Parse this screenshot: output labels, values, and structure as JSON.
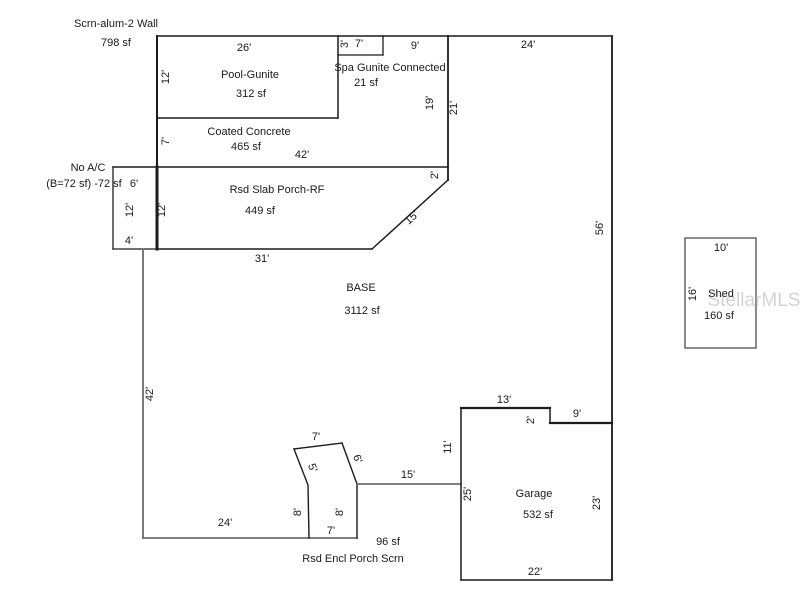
{
  "floor_plan": {
    "canvas": {
      "width": 800,
      "height": 600,
      "background": "#ffffff"
    },
    "colors": {
      "line": "#1c1c1c",
      "muted_line": "#6e6e6e",
      "base_edge": "#7a7a7a",
      "shed_line": "#4a4a4a",
      "text": "#1a1a1a",
      "watermark": "#c9c9c9"
    },
    "areas": [
      {
        "name": "Scrn-alum-2 Wall",
        "size": "798 sf"
      },
      {
        "name": "Pool-Gunite",
        "size": "312 sf"
      },
      {
        "name": "Spa Gunite Connected",
        "size": "21 sf"
      },
      {
        "name": "Coated Concrete",
        "size": "465 sf"
      },
      {
        "name": "No A/C",
        "size": "(B=72 sf) -72 sf"
      },
      {
        "name": "Rsd Slab Porch-RF",
        "size": "449 sf"
      },
      {
        "name": "BASE",
        "size": "3112 sf"
      },
      {
        "name": "Rsd Encl Porch Scrn",
        "size": "96 sf"
      },
      {
        "name": "Garage",
        "size": "532 sf"
      },
      {
        "name": "Shed",
        "size": "160 sf"
      }
    ],
    "watermark": {
      "text": "StellarMLS",
      "x": 754,
      "y": 301,
      "size": 19
    },
    "lines": [
      {
        "name": "top-wall",
        "points": [
          [
            157,
            36
          ],
          [
            612,
            36
          ]
        ],
        "w": 1.5
      },
      {
        "name": "enclosure-left-wall",
        "points": [
          [
            157,
            36
          ],
          [
            157,
            167
          ]
        ],
        "w": 2
      },
      {
        "name": "slab-porch-left-wall",
        "points": [
          [
            157,
            167
          ],
          [
            157,
            249
          ]
        ],
        "w": 3
      },
      {
        "name": "pool-bottom-wall",
        "points": [
          [
            157,
            118
          ],
          [
            338,
            118
          ]
        ],
        "w": 1.5
      },
      {
        "name": "pool-right-wall",
        "points": [
          [
            338,
            36
          ],
          [
            338,
            118
          ]
        ],
        "w": 1.5
      },
      {
        "name": "spa-bottom-wall",
        "points": [
          [
            338,
            55
          ],
          [
            383,
            55
          ]
        ],
        "w": 1.3
      },
      {
        "name": "spa-right-wall",
        "points": [
          [
            383,
            36
          ],
          [
            383,
            55
          ]
        ],
        "w": 1.3
      },
      {
        "name": "enclosure-right-wall",
        "points": [
          [
            448,
            36
          ],
          [
            448,
            180
          ]
        ],
        "w": 1.8
      },
      {
        "name": "slab-porch-top-wall",
        "points": [
          [
            113,
            167
          ],
          [
            448,
            167
          ]
        ],
        "w": 1.5
      },
      {
        "name": "noac-left-wall",
        "points": [
          [
            113,
            167
          ],
          [
            113,
            249
          ]
        ],
        "w": 1.3
      },
      {
        "name": "noac-bottom-wall",
        "points": [
          [
            113,
            249
          ],
          [
            157,
            249
          ]
        ],
        "w": 1.3
      },
      {
        "name": "slab-porch-bottom-wall",
        "points": [
          [
            157,
            249
          ],
          [
            372,
            249
          ]
        ],
        "w": 1.5
      },
      {
        "name": "slab-porch-diagonal-wall",
        "points": [
          [
            372,
            249
          ],
          [
            448,
            180
          ]
        ],
        "w": 1.5
      },
      {
        "name": "base-left-wall",
        "points": [
          [
            143,
            249
          ],
          [
            143,
            538
          ]
        ],
        "w": 2,
        "c": "#7a7a7a"
      },
      {
        "name": "base-bottom-wall",
        "points": [
          [
            143,
            538
          ],
          [
            357,
            538
          ]
        ],
        "w": 1.8,
        "c": "#6e6e6e"
      },
      {
        "name": "encl-porch-left-wall",
        "points": [
          [
            309,
            538
          ],
          [
            308,
            485
          ],
          [
            294,
            449
          ]
        ],
        "w": 1.4
      },
      {
        "name": "encl-porch-top-wall",
        "points": [
          [
            294,
            449
          ],
          [
            342,
            443
          ]
        ],
        "w": 1.4
      },
      {
        "name": "encl-porch-upper-right-wall",
        "points": [
          [
            342,
            443
          ],
          [
            357,
            484
          ]
        ],
        "w": 1.4
      },
      {
        "name": "encl-porch-right-wall",
        "points": [
          [
            357,
            484
          ],
          [
            357,
            538
          ]
        ],
        "w": 1.4
      },
      {
        "name": "base-lower-wall",
        "points": [
          [
            357,
            484
          ],
          [
            461,
            484
          ]
        ],
        "w": 1.8,
        "c": "#6e6e6e"
      },
      {
        "name": "garage-left-wall",
        "points": [
          [
            461,
            408
          ],
          [
            461,
            580
          ]
        ],
        "w": 1.5
      },
      {
        "name": "garage-top-wall",
        "points": [
          [
            461,
            408
          ],
          [
            550,
            408
          ]
        ],
        "w": 2.2
      },
      {
        "name": "garage-notch-wall",
        "points": [
          [
            550,
            408
          ],
          [
            550,
            423
          ]
        ],
        "w": 1.5
      },
      {
        "name": "garage-upper-right-wall",
        "points": [
          [
            550,
            423
          ],
          [
            612,
            423
          ]
        ],
        "w": 2.2
      },
      {
        "name": "right-wall",
        "points": [
          [
            612,
            36
          ],
          [
            612,
            580
          ]
        ],
        "w": 1.8
      },
      {
        "name": "garage-bottom-wall",
        "points": [
          [
            461,
            580
          ],
          [
            612,
            580
          ]
        ],
        "w": 1.5
      },
      {
        "name": "shed-outline",
        "points": [
          [
            685,
            238
          ],
          [
            756,
            238
          ],
          [
            756,
            348
          ],
          [
            685,
            348
          ],
          [
            685,
            238
          ]
        ],
        "w": 1.3,
        "c": "#4a4a4a"
      }
    ],
    "labels": [
      {
        "name": "scrn-wall-title",
        "text": "Scrn-alum-2 Wall",
        "x": 116,
        "y": 24
      },
      {
        "name": "scrn-wall-size",
        "text": "798 sf",
        "x": 116,
        "y": 43
      },
      {
        "name": "dim",
        "text": "26'",
        "x": 244,
        "y": 48
      },
      {
        "name": "dim",
        "text": "12'",
        "x": 166,
        "y": 77,
        "rot": -90
      },
      {
        "name": "pool-title",
        "text": "Pool-Gunite",
        "x": 250,
        "y": 75
      },
      {
        "name": "pool-size",
        "text": "312 sf",
        "x": 251,
        "y": 94
      },
      {
        "name": "dim",
        "text": "3'",
        "x": 345,
        "y": 44,
        "rot": -90
      },
      {
        "name": "dim",
        "text": "7'",
        "x": 359,
        "y": 44
      },
      {
        "name": "dim",
        "text": "9'",
        "x": 415,
        "y": 46
      },
      {
        "name": "dim",
        "text": "24'",
        "x": 528,
        "y": 45
      },
      {
        "name": "spa-title",
        "text": "Spa Gunite Connected",
        "x": 390,
        "y": 68
      },
      {
        "name": "spa-size",
        "text": "21 sf",
        "x": 366,
        "y": 83
      },
      {
        "name": "coated-concrete-title",
        "text": "Coated Concrete",
        "x": 249,
        "y": 132
      },
      {
        "name": "coated-concrete-size",
        "text": "465 sf",
        "x": 246,
        "y": 147
      },
      {
        "name": "dim",
        "text": "7'",
        "x": 166,
        "y": 141,
        "rot": -90
      },
      {
        "name": "dim",
        "text": "42'",
        "x": 302,
        "y": 155
      },
      {
        "name": "dim",
        "text": "19'",
        "x": 430,
        "y": 103,
        "rot": -90
      },
      {
        "name": "dim",
        "text": "21'",
        "x": 454,
        "y": 108,
        "rot": -90
      },
      {
        "name": "noac-title",
        "text": "No A/C",
        "x": 88,
        "y": 168
      },
      {
        "name": "noac-note",
        "text": "(B=72 sf) -72 sf",
        "x": 84,
        "y": 184
      },
      {
        "name": "dim",
        "text": "6'",
        "x": 134,
        "y": 184
      },
      {
        "name": "dim",
        "text": "12'",
        "x": 130,
        "y": 210,
        "rot": -90
      },
      {
        "name": "dim",
        "text": "12'",
        "x": 162,
        "y": 210,
        "rot": -90
      },
      {
        "name": "slab-porch-title",
        "text": "Rsd Slab Porch-RF",
        "x": 277,
        "y": 190
      },
      {
        "name": "slab-porch-size",
        "text": "449 sf",
        "x": 260,
        "y": 211
      },
      {
        "name": "dim",
        "text": "2'",
        "x": 435,
        "y": 175,
        "rot": -90
      },
      {
        "name": "dim",
        "text": "15'",
        "x": 412,
        "y": 218,
        "rot": -42
      },
      {
        "name": "dim",
        "text": "4'",
        "x": 129,
        "y": 241
      },
      {
        "name": "dim",
        "text": "31'",
        "x": 262,
        "y": 259
      },
      {
        "name": "base-title",
        "text": "BASE",
        "x": 361,
        "y": 288
      },
      {
        "name": "base-size",
        "text": "3112 sf",
        "x": 362,
        "y": 311
      },
      {
        "name": "dim",
        "text": "56'",
        "x": 600,
        "y": 228,
        "rot": -90
      },
      {
        "name": "dim",
        "text": "42'",
        "x": 150,
        "y": 394,
        "rot": -90
      },
      {
        "name": "dim",
        "text": "7'",
        "x": 316,
        "y": 437
      },
      {
        "name": "dim",
        "text": "5'",
        "x": 312,
        "y": 468,
        "rot": 70
      },
      {
        "name": "dim",
        "text": "6'",
        "x": 357,
        "y": 459,
        "rot": 70
      },
      {
        "name": "dim",
        "text": "8'",
        "x": 298,
        "y": 512,
        "rot": -90
      },
      {
        "name": "dim",
        "text": "8'",
        "x": 340,
        "y": 512,
        "rot": -90
      },
      {
        "name": "dim",
        "text": "7'",
        "x": 331,
        "y": 531
      },
      {
        "name": "dim",
        "text": "24'",
        "x": 225,
        "y": 523
      },
      {
        "name": "dim",
        "text": "15'",
        "x": 408,
        "y": 475
      },
      {
        "name": "encl-porch-size",
        "text": "96 sf",
        "x": 388,
        "y": 542
      },
      {
        "name": "encl-porch-title",
        "text": "Rsd Encl Porch Scrn",
        "x": 353,
        "y": 559
      },
      {
        "name": "dim",
        "text": "11'",
        "x": 448,
        "y": 447,
        "rot": -90
      },
      {
        "name": "dim",
        "text": "13'",
        "x": 504,
        "y": 400
      },
      {
        "name": "dim",
        "text": "2'",
        "x": 531,
        "y": 420,
        "rot": -90
      },
      {
        "name": "dim",
        "text": "9'",
        "x": 577,
        "y": 414
      },
      {
        "name": "dim",
        "text": "25'",
        "x": 468,
        "y": 494,
        "rot": -90
      },
      {
        "name": "garage-title",
        "text": "Garage",
        "x": 534,
        "y": 494
      },
      {
        "name": "garage-size",
        "text": "532 sf",
        "x": 538,
        "y": 515
      },
      {
        "name": "dim",
        "text": "23'",
        "x": 597,
        "y": 503,
        "rot": -90
      },
      {
        "name": "dim",
        "text": "22'",
        "x": 535,
        "y": 572
      },
      {
        "name": "dim",
        "text": "10'",
        "x": 721,
        "y": 248
      },
      {
        "name": "dim",
        "text": "16'",
        "x": 693,
        "y": 294,
        "rot": -90
      },
      {
        "name": "shed-title",
        "text": "Shed",
        "x": 721,
        "y": 294
      },
      {
        "name": "shed-size",
        "text": "160 sf",
        "x": 719,
        "y": 316
      }
    ]
  }
}
